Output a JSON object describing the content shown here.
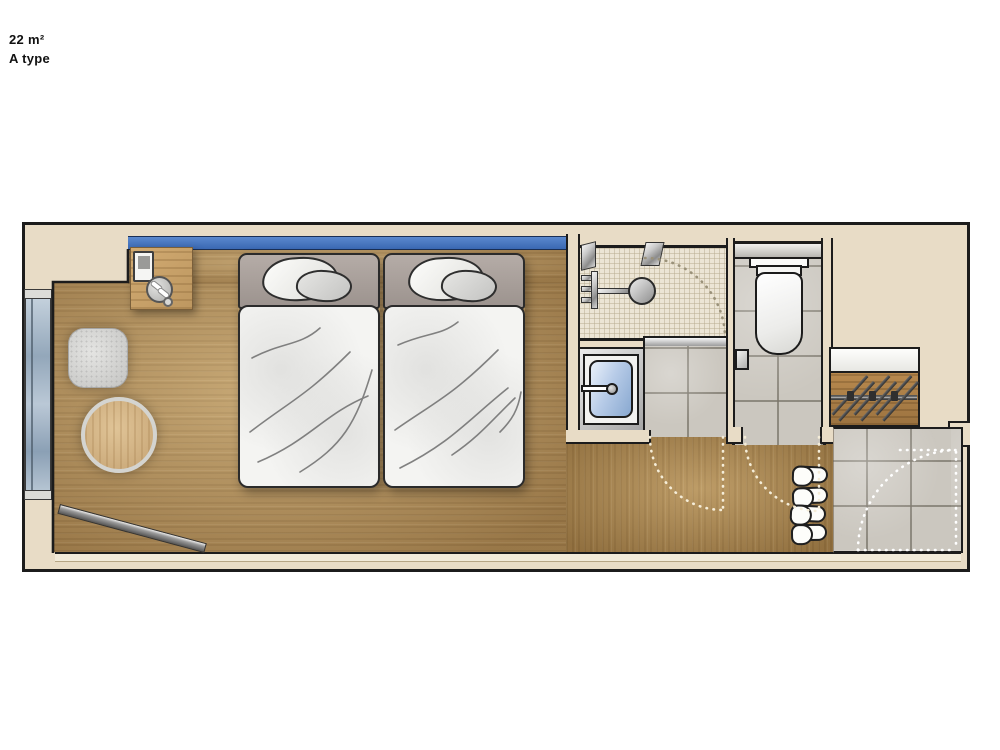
{
  "title_block": {
    "area_label": "22 m²",
    "type_label": "A type"
  },
  "palette": {
    "wall_fill": "#e8dcc6",
    "outline": "#1c1c1c",
    "wood_floor": "#b18d58",
    "headboard_accent": "#4579c4",
    "shower_tile": "#ece5d5",
    "gray_tile": "#cbc7bf",
    "window_glass": "#a8bccd",
    "sink_basin": "#9db9dd",
    "fixture_white": "#f7f7f4"
  }
}
